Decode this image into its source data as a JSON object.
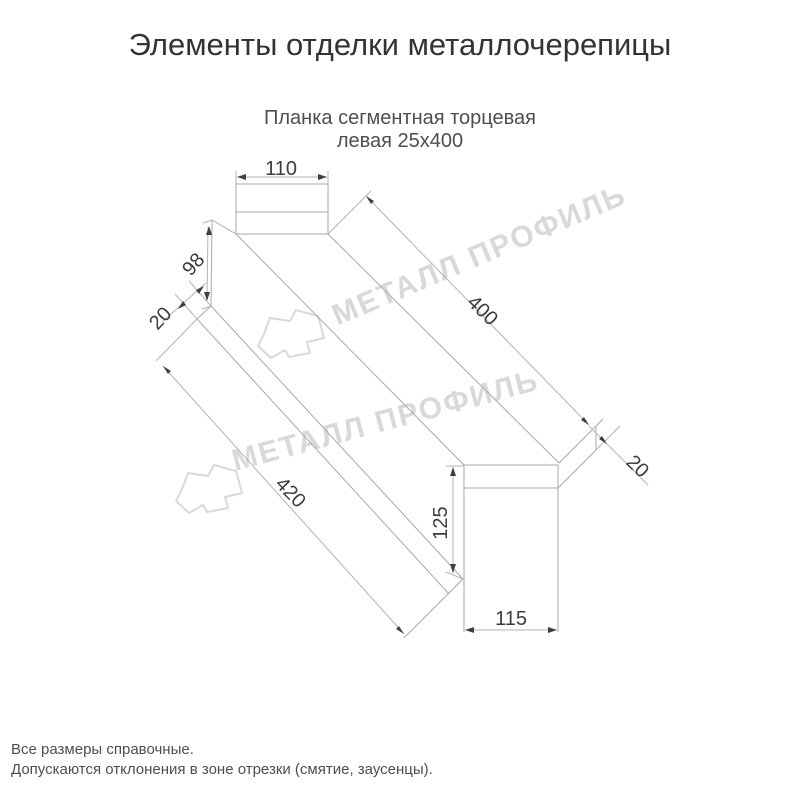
{
  "header": {
    "title": "Элементы отделки металлочерепицы"
  },
  "product": {
    "name_line1": "Планка сегментная торцевая",
    "name_line2": "левая 25х400"
  },
  "diagram": {
    "watermark_text": "МЕТАЛЛ ПРОФИЛЬ",
    "dims": {
      "top_width": "110",
      "far_end_height": "98",
      "far_hem": "20",
      "top_length": "400",
      "near_hem": "20",
      "bottom_length": "420",
      "near_end_height": "125",
      "bottom_width": "115"
    }
  },
  "footer": {
    "note1": "Все размеры справочные.",
    "note2": "Допускаются отклонения в зоне отрезки (смятие, заусенцы)."
  },
  "colors": {
    "line": "#a9a9a9",
    "dim_text": "#3c3c3c",
    "watermark": "#d9d9d9",
    "title_text": "#333333",
    "body_text": "#4e4e4e",
    "background": "#ffffff"
  }
}
